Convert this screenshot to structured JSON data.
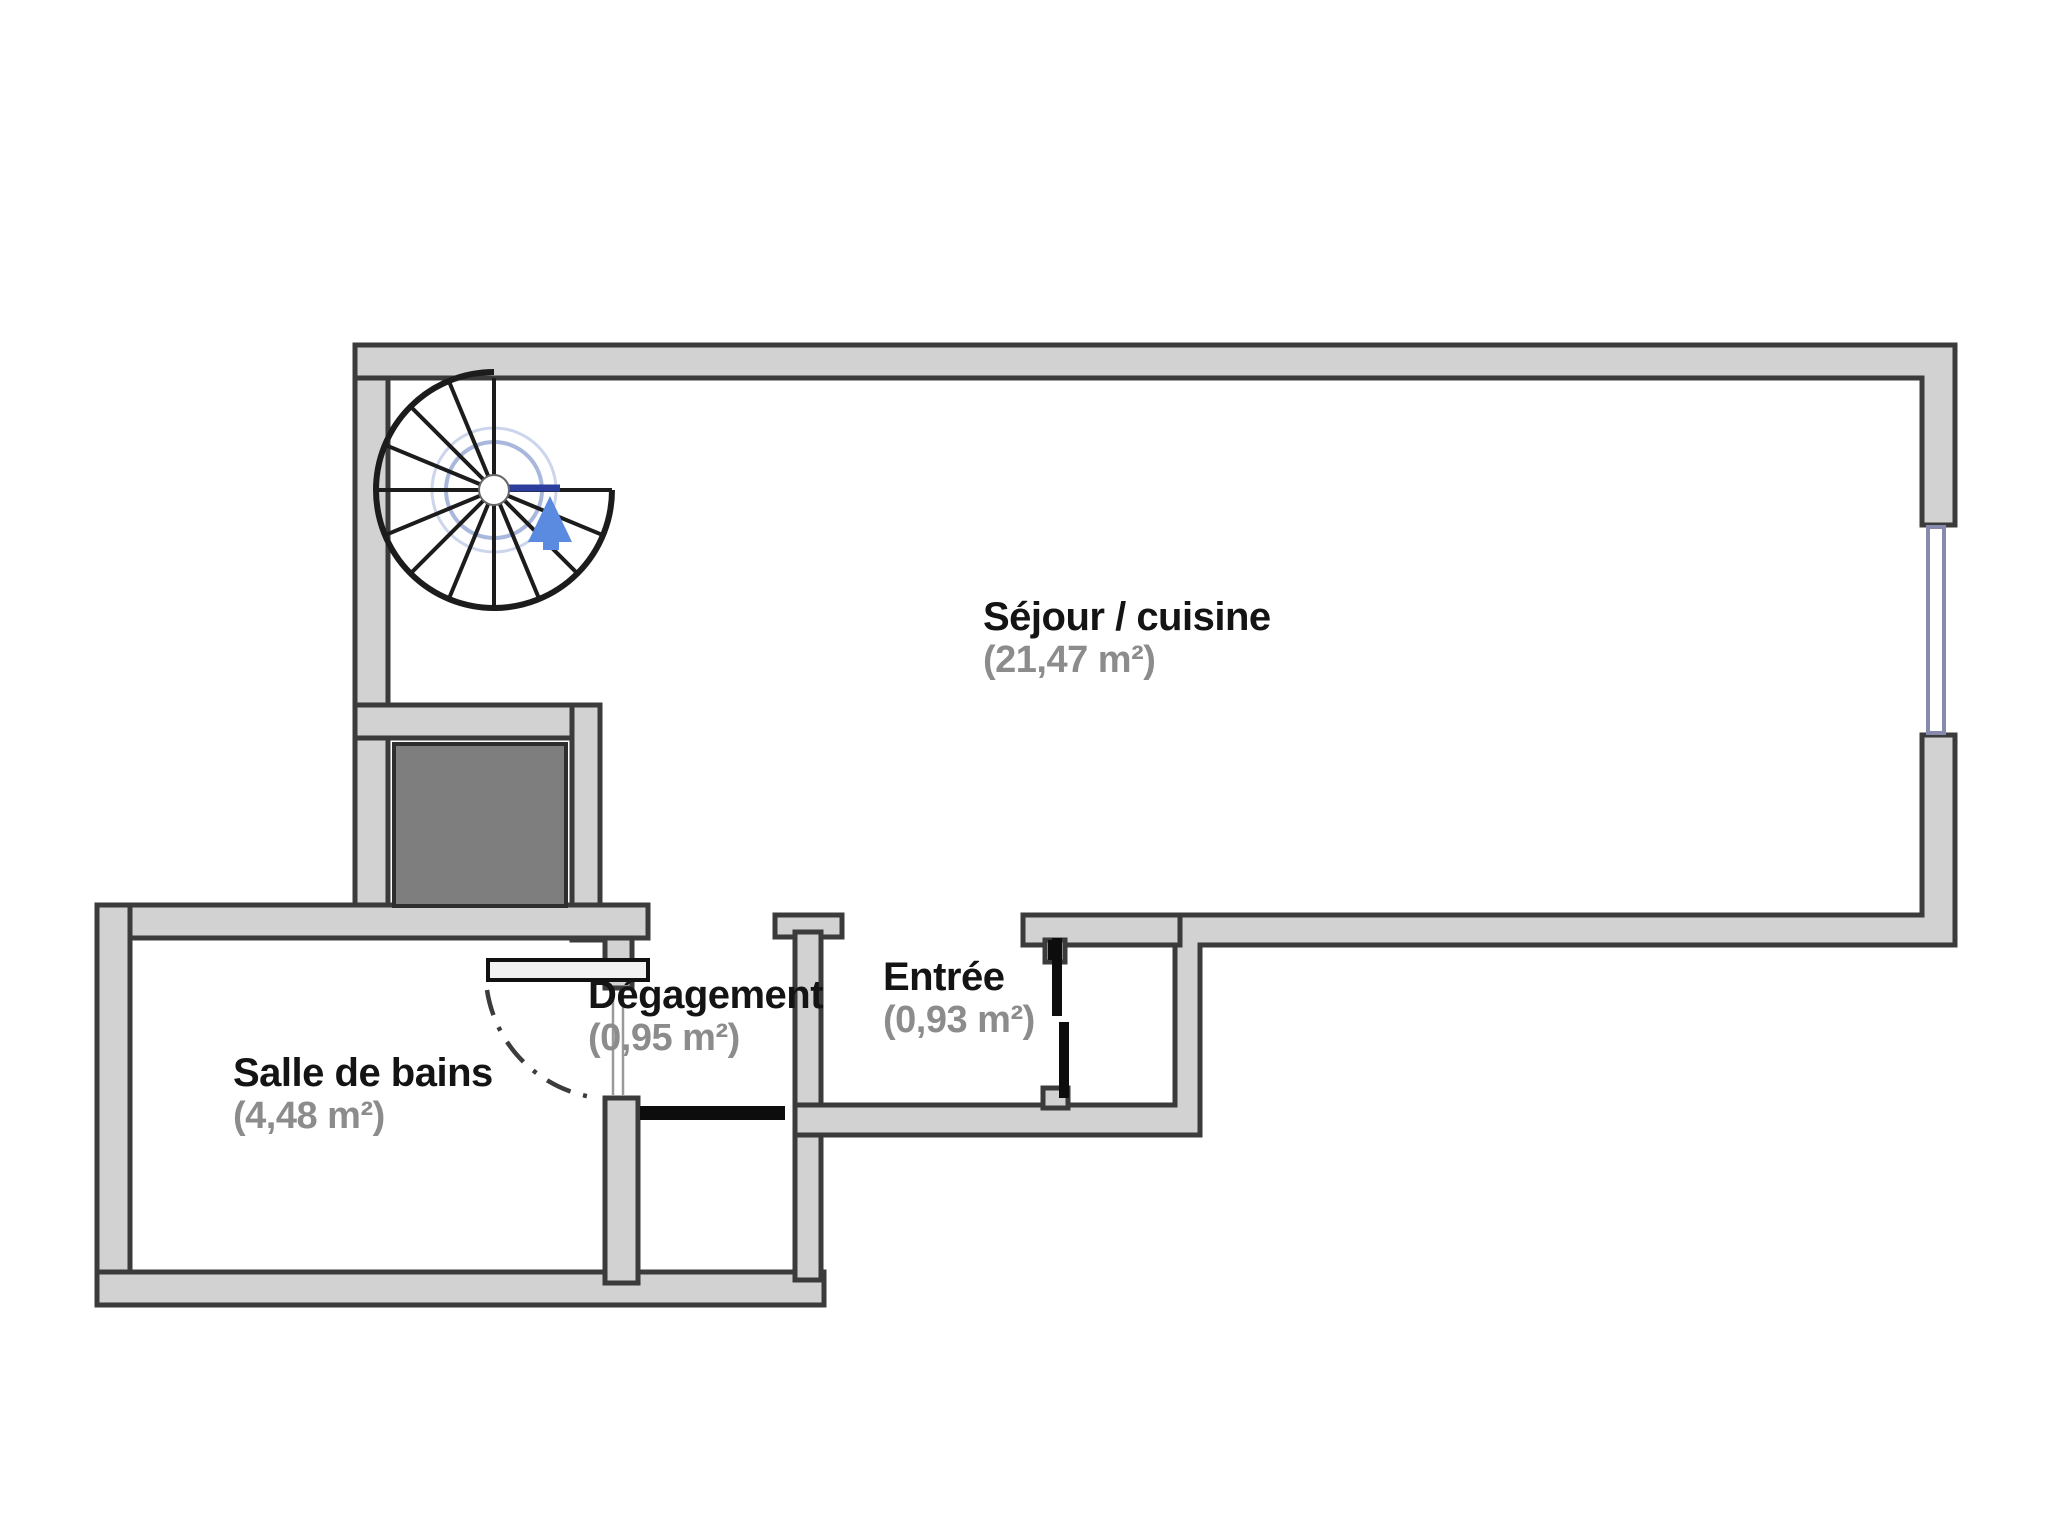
{
  "plan": {
    "type": "apartment-floor-plan",
    "rooms": {
      "sejour": {
        "name": "Séjour / cuisine",
        "area": "(21,47 m²)"
      },
      "bains": {
        "name": "Salle de bains",
        "area": "(4,48 m²)"
      },
      "degagement": {
        "name": "Dégagement",
        "area": "(0,95 m²)"
      },
      "entree": {
        "name": "Entrée",
        "area": "(0,93 m²)"
      }
    },
    "features": {
      "spiral_staircase": "spiral-staircase-with-up-arrow",
      "technical_shaft": "solid-dark-shaft-block",
      "window": "double-line-window-right-wall",
      "entrance_door": "black-door-leaf",
      "bathroom_door": "open-leaf-with-dash-dot-swing-arc",
      "storage_door": "black-door-leaf-below-hallway"
    },
    "colors": {
      "background": "#ffffff",
      "wall_fill": "#d2d2d2",
      "wall_outline": "#3b3b3b",
      "shaft_fill": "#7e7e7e",
      "room_label": "#141414",
      "area_label": "#8c8c8c",
      "window": "#8789ad",
      "stair_guide": "#a9b7dc",
      "stair_accent": "#2b3e9e",
      "stair_arrow": "#5b8be0"
    }
  }
}
